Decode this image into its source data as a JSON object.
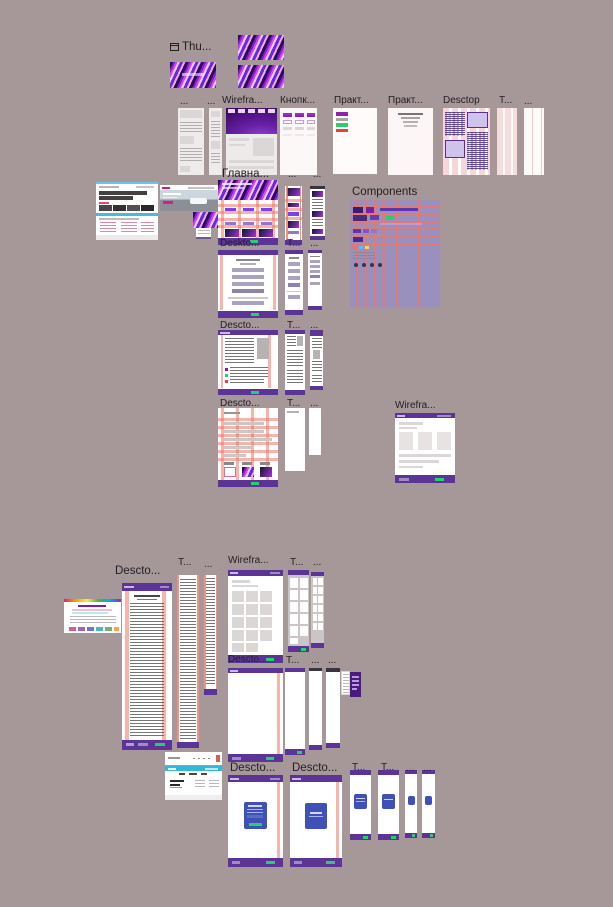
{
  "app": {
    "type": "design-canvas-overview"
  },
  "colors": {
    "canvas_bg": "#a69798",
    "frame_purple": "#5c3496",
    "guide_salmon": "#f07664",
    "pink_column_bg": "#f6d6d6",
    "accent_green": "#2ecc71",
    "indigo_card": "#3f51b5",
    "cyan_bar": "#35b6d9",
    "button_purple": "#9c27b0",
    "components_bg": "#9a90bd",
    "gradient_dark_purple": "#2e0a57",
    "gradient_magenta": "#d946ef"
  },
  "labels": {
    "thumbs": "Thu...",
    "row1": [
      "...",
      "...",
      "Wirefra...",
      "Кнопк...",
      "Практ...",
      "Практ...",
      "Desctop",
      "T...",
      "..."
    ],
    "hero": {
      "main": "Главна...",
      "t": "...",
      "m": "...",
      "components": "Components"
    },
    "form": [
      "Deskto...",
      "T...",
      "..."
    ],
    "article": [
      "Descto...",
      "T...",
      "..."
    ],
    "grid": [
      "Descto...",
      "T...",
      "...",
      "Wirefra..."
    ],
    "doc": [
      "Descto...",
      "T...",
      "..."
    ],
    "wireframe": [
      "Wirefra...",
      "T...",
      "..."
    ],
    "blank": [
      "Descto...",
      "T...",
      "...",
      "..."
    ],
    "login": [
      "Descto...",
      "Descto...",
      "T...",
      "T...",
      "...",
      "..."
    ]
  },
  "icons": {
    "thumbs_window_icon": "window-icon"
  }
}
